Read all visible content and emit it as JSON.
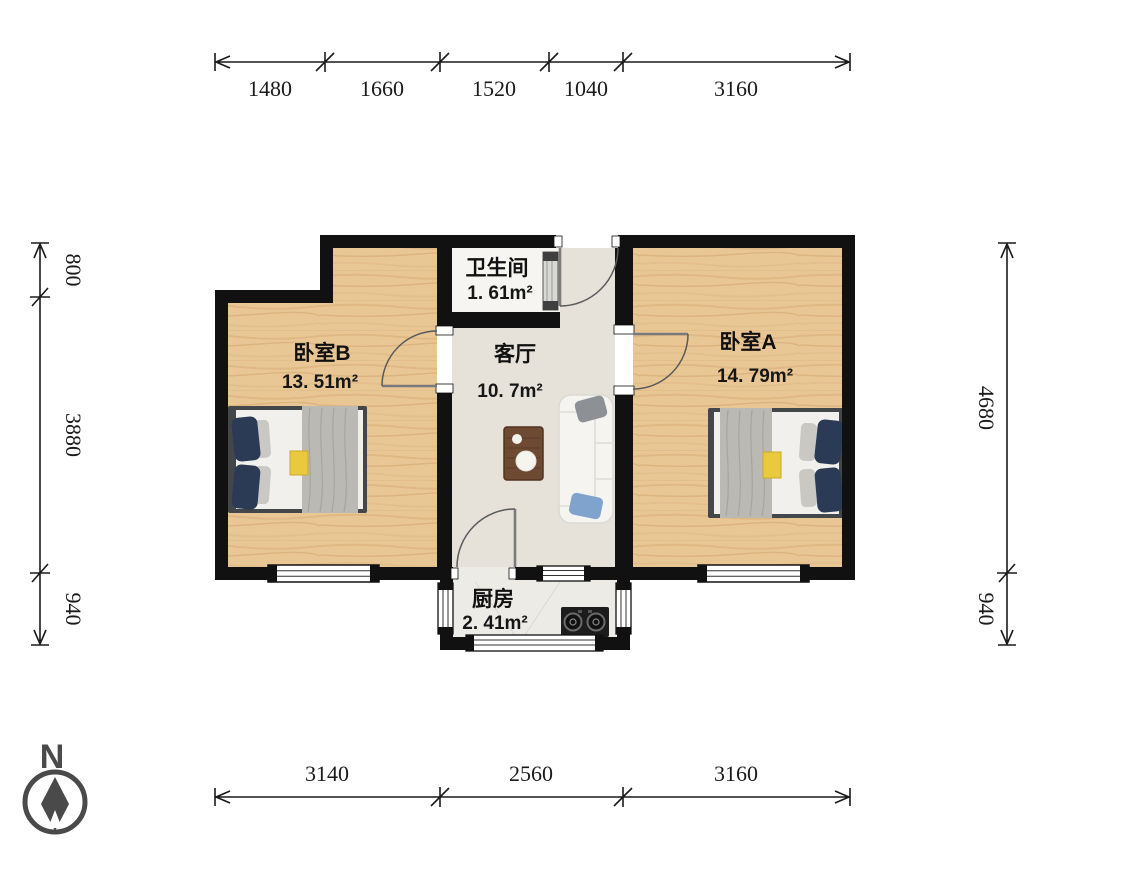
{
  "compass": {
    "label": "N"
  },
  "rooms": {
    "bedroom_b": {
      "name": "卧室B",
      "area": "13. 51m²"
    },
    "bathroom": {
      "name": "卫生间",
      "area": "1. 61m²"
    },
    "living": {
      "name": "客厅",
      "area": "10. 7m²"
    },
    "bedroom_a": {
      "name": "卧室A",
      "area": "14. 79m²"
    },
    "kitchen": {
      "name": "厨房",
      "area": "2. 41m²"
    }
  },
  "dimensions": {
    "top": [
      "1480",
      "1660",
      "1520",
      "1040",
      "3160"
    ],
    "bottom": [
      "3140",
      "2560",
      "3160"
    ],
    "left": [
      "800",
      "3880",
      "940"
    ],
    "right": [
      "4680",
      "940"
    ]
  },
  "colors": {
    "wall": "#111111",
    "wood_floor": "#e8c697",
    "tile_floor": "#e6e2da",
    "bathroom_floor": "#f6f5f1",
    "kitchen_floor": "#edebe6",
    "bed_frame": "#43474a",
    "pillow_navy": "#2b3a55",
    "blanket_grey": "#b9b8b3",
    "sofa_white": "#f4f3ef",
    "pillow_blue": "#7fa3cc",
    "table_wood": "#6e4a33",
    "accent_yellow": "#e9c93e",
    "compass_grey": "#4a4a4a",
    "dimension_text": "#1a1a1a"
  }
}
